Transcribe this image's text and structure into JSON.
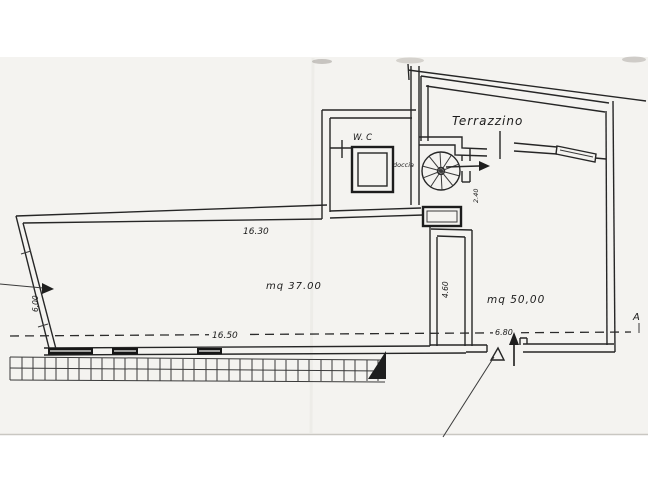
{
  "colors": {
    "paper": "#f4f3f0",
    "ink": "#262626",
    "window_fill": "#161616"
  },
  "plan": {
    "room_labels": {
      "terrazzino": "Terrazzino",
      "wc": "W. C",
      "doccia": "doccia"
    },
    "area_labels": {
      "left_room": "mq  37.00",
      "right_room": "mq 50,00"
    },
    "dimensions": {
      "top_width": "16.30",
      "bottom_width": "16.50",
      "entry_width": "6.80",
      "left_height": "6.00",
      "middle_height": "4.60",
      "stair_passage": "2.40"
    },
    "section_marker": "A"
  }
}
